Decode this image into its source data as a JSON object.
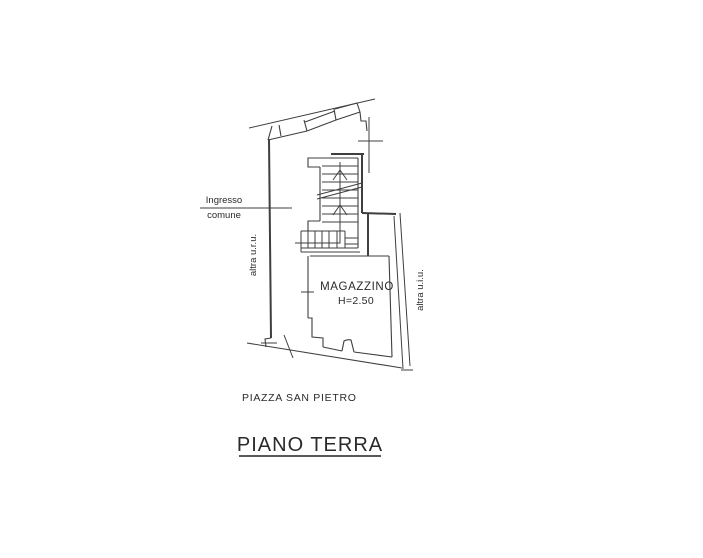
{
  "style": {
    "background": "#ffffff",
    "line_color": "#3f3f3f",
    "text_color": "#2a2a2a"
  },
  "plan": {
    "title": "PIANO TERRA",
    "street": "PIAZZA SAN PIETRO",
    "room": {
      "name": "MAGAZZINO",
      "height": "H=2.50"
    },
    "entrance": {
      "line1": "Ingresso",
      "line2": "comune"
    },
    "left_unit_label": "altra u.r.u.",
    "right_unit_label": "altra u.i.u.",
    "stair_up_arrow_icon": "up-arrow",
    "survey_cross_icon": "survey-cross"
  }
}
